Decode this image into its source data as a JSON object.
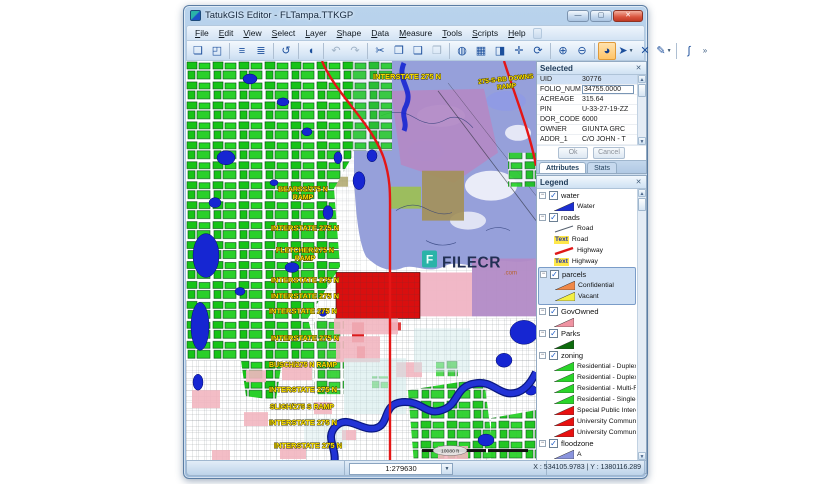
{
  "window": {
    "title": "TatukGIS Editor - FLTampa.TTKGP",
    "controls": [
      {
        "name": "minimize-button",
        "glyph": "—"
      },
      {
        "name": "maximize-button",
        "glyph": "▢"
      },
      {
        "name": "close-button",
        "glyph": "✕"
      }
    ]
  },
  "menu": {
    "items": [
      "File",
      "Edit",
      "View",
      "Select",
      "Layer",
      "Shape",
      "Data",
      "Measure",
      "Tools",
      "Scripts",
      "Help"
    ]
  },
  "toolbar": {
    "buttons": [
      {
        "name": "new-file-icon",
        "glyph": "❏"
      },
      {
        "name": "open-file-icon",
        "glyph": "◰"
      },
      {
        "name": "sep"
      },
      {
        "name": "layer-list-icon",
        "glyph": "≡"
      },
      {
        "name": "layer-properties-icon",
        "glyph": "≣"
      },
      {
        "name": "sep"
      },
      {
        "name": "revert-icon",
        "glyph": "↺"
      },
      {
        "name": "sep"
      },
      {
        "name": "shape-info-icon",
        "glyph": "◖"
      },
      {
        "name": "sep"
      },
      {
        "name": "undo-icon",
        "glyph": "↶",
        "disabled": true
      },
      {
        "name": "redo-icon",
        "glyph": "↷",
        "disabled": true
      },
      {
        "name": "sep"
      },
      {
        "name": "cut-icon",
        "glyph": "✂"
      },
      {
        "name": "copy-icon",
        "glyph": "❐"
      },
      {
        "name": "paste-icon",
        "glyph": "❑"
      },
      {
        "name": "paste-special-icon",
        "glyph": "❒",
        "disabled": true
      },
      {
        "name": "sep"
      },
      {
        "name": "full-extent-icon",
        "glyph": "◍"
      },
      {
        "name": "edit-vertices-icon",
        "glyph": "▦"
      },
      {
        "name": "preview-icon",
        "glyph": "◨"
      },
      {
        "name": "pan-arrows-icon",
        "glyph": "✛"
      },
      {
        "name": "refresh-icon",
        "glyph": "⟳"
      },
      {
        "name": "sep"
      },
      {
        "name": "zoom-in-icon",
        "glyph": "⊕"
      },
      {
        "name": "zoom-out-icon",
        "glyph": "⊖"
      },
      {
        "name": "sep"
      },
      {
        "name": "zoom-mode-icon",
        "glyph": "◕",
        "active": true
      },
      {
        "name": "select-arrow-icon",
        "glyph": "➤",
        "dropdown": true
      },
      {
        "name": "deselect-icon",
        "glyph": "✕"
      },
      {
        "name": "draw-pen-icon",
        "glyph": "✎",
        "dropdown": true
      },
      {
        "name": "sep"
      },
      {
        "name": "measure-arc-icon",
        "glyph": "∫"
      }
    ],
    "overflow_glyph": "»"
  },
  "selected_panel": {
    "title": "Selected",
    "rows": [
      {
        "field": "UID",
        "value": "30776",
        "selected": true
      },
      {
        "field": "FOLIO_NUMB",
        "value": "34755.0000",
        "editing": true
      },
      {
        "field": "ACREAGE",
        "value": "315.64"
      },
      {
        "field": "PIN",
        "value": "U-33-27-19-ZZ"
      },
      {
        "field": "DOR_CODE",
        "value": "6000"
      },
      {
        "field": "OWNER",
        "value": "GIUNTA GRC"
      },
      {
        "field": "ADDR_1",
        "value": "C/O JOHN - T"
      }
    ],
    "ok_label": "Ok",
    "cancel_label": "Cancel",
    "tabs": [
      {
        "label": "Attributes",
        "active": true
      },
      {
        "label": "Stats",
        "active": false
      }
    ]
  },
  "legend_panel": {
    "title": "Legend",
    "layers": [
      {
        "name": "water",
        "checked": true,
        "items": [
          {
            "type": "tri",
            "color": "#1c2fd2",
            "label": "Water"
          }
        ]
      },
      {
        "name": "roads",
        "checked": true,
        "items": [
          {
            "type": "line",
            "color": "#55606e",
            "width": 1,
            "label": "Road"
          },
          {
            "type": "text",
            "label": "Road"
          },
          {
            "type": "line",
            "color": "#e01818",
            "width": 2.5,
            "label": "Highway"
          },
          {
            "type": "text",
            "label": "Highway"
          }
        ]
      },
      {
        "name": "parcels",
        "checked": true,
        "selected": true,
        "items": [
          {
            "type": "tri",
            "color": "#f08848",
            "label": "Confidential"
          },
          {
            "type": "tri",
            "color": "#f3ef44",
            "label": "Vacant"
          }
        ]
      },
      {
        "name": "GovOwned",
        "checked": true,
        "items": [
          {
            "type": "tri",
            "color": "#ef93a2",
            "label": ""
          }
        ]
      },
      {
        "name": "Parks",
        "checked": true,
        "items": [
          {
            "type": "tri",
            "color": "#0d6b0d",
            "label": ""
          }
        ]
      },
      {
        "name": "zoning",
        "checked": true,
        "items": [
          {
            "type": "tri",
            "color": "#2ad42a",
            "label": "Residential - Duplex"
          },
          {
            "type": "tri",
            "color": "#2ad42a",
            "label": "Residential - Duplex"
          },
          {
            "type": "tri",
            "color": "#2ad42a",
            "label": "Residential - Multi-Fa"
          },
          {
            "type": "tri",
            "color": "#2ad42a",
            "label": "Residential - Single-F"
          },
          {
            "type": "tri",
            "color": "#e81111",
            "label": "Special Public Interes"
          },
          {
            "type": "tri",
            "color": "#e81111",
            "label": "University Communit"
          },
          {
            "type": "tri",
            "color": "#e81111",
            "label": "University Communit"
          }
        ]
      },
      {
        "name": "floodzone",
        "checked": true,
        "items": [
          {
            "type": "tri",
            "color": "#8a94dd",
            "label": "A"
          }
        ]
      }
    ],
    "tabs": [
      {
        "label": "Layers",
        "active": true
      },
      {
        "label": "Hierarchy",
        "active": false
      }
    ]
  },
  "statusbar": {
    "scale": "1:279630",
    "coordinates": "X : 534105.9783 | Y : 1380116.289"
  },
  "map": {
    "watermark": {
      "text": "FILECR",
      "suffix": ".com"
    },
    "scalebar_label": "10080 ft",
    "label_color": "#ffe400",
    "labels": [
      {
        "text": "INTERSTATE 275 N",
        "x": 221,
        "y": 18,
        "fs": 7.5
      },
      {
        "text": "275-S-BB DOWNS\nRAMP",
        "x": 320,
        "y": 20,
        "fs": 6.5,
        "rot": -6
      },
      {
        "text": "BEARSS/275 N\nRAMP",
        "x": 117,
        "y": 131,
        "fs": 7
      },
      {
        "text": "INTERSTATE 275 N",
        "x": 119,
        "y": 170,
        "fs": 7.5
      },
      {
        "text": "FLETCHER/275 N\nRAMP",
        "x": 119,
        "y": 192,
        "fs": 7
      },
      {
        "text": "INTERSTATE 275 N",
        "x": 119,
        "y": 222,
        "fs": 7.5
      },
      {
        "text": "INTERSTATE 275 N",
        "x": 119,
        "y": 238,
        "fs": 7.5
      },
      {
        "text": "INTERSTATE 275 N",
        "x": 117,
        "y": 253,
        "fs": 7.5
      },
      {
        "text": "INTERSTATE 275 N",
        "x": 119,
        "y": 280,
        "fs": 7.5
      },
      {
        "text": "BUSCH/275 N RAMP",
        "x": 117,
        "y": 307,
        "fs": 7
      },
      {
        "text": "INTERSTATE 275 N",
        "x": 117,
        "y": 332,
        "fs": 7.5
      },
      {
        "text": "SLIGH/275 S RAMP",
        "x": 116,
        "y": 349,
        "fs": 7
      },
      {
        "text": "INTERSTATE 275 N",
        "x": 117,
        "y": 365,
        "fs": 7.5
      },
      {
        "text": "INTERSTATE 275 N",
        "x": 122,
        "y": 388,
        "fs": 7.5
      }
    ]
  }
}
